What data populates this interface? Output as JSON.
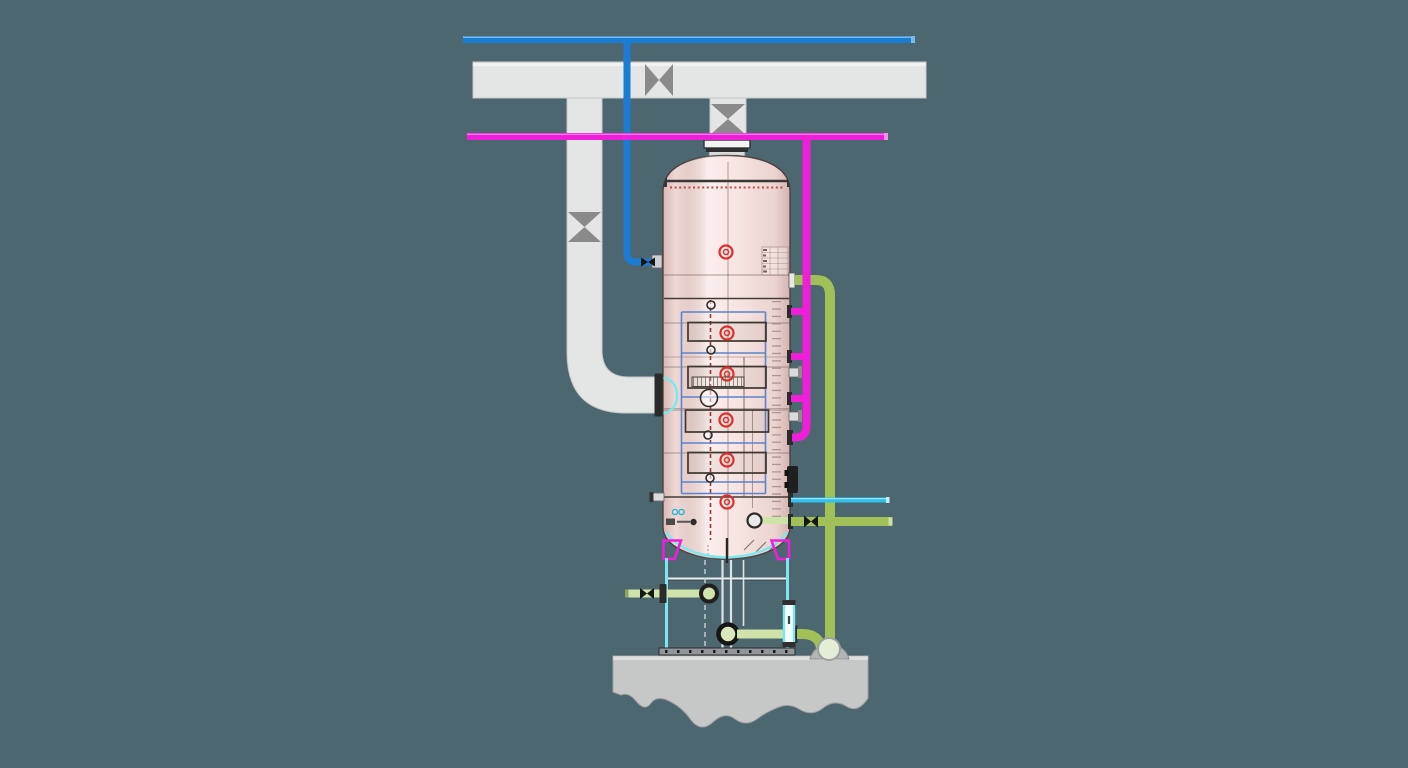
{
  "scene": {
    "type": "plant-equipment-illustration",
    "subject": "vertical scrubber column with exhaust ductwork, feed and recirculation piping on a concrete foundation",
    "canvas": {
      "width": 1408,
      "height": 768
    },
    "visible_text": ""
  },
  "colors": {
    "background": "#4d6770",
    "duct": "#e4e5e5",
    "duct_shadow": "#c6c8c8",
    "damper": "#8a8a8a",
    "blue_pipe": "#1b7cd4",
    "magenta_pipe": "#ef1fd9",
    "green_pipe": "#a0c158",
    "pale_green_pipe": "#cde3a9",
    "cyan_pipe": "#2fc0ee",
    "skirt_cyan": "#7be8f0",
    "vessel_pink": "#f6e1de",
    "internals_dark": "#453c36",
    "internals_blue": "#5c84ca",
    "handwheel_red": "#dd2f2a",
    "flange_dark": "#2b2b2b",
    "concrete": "#c6c8c8",
    "base_plate": "#90979a"
  },
  "components": {
    "duct_system": {
      "name": "exhaust-duct",
      "damper_count": 3
    },
    "vessel": {
      "name": "scrubber-column",
      "tray_count": 4,
      "handwheel_count": 6,
      "side_nozzle_count": 7
    },
    "pipes": [
      {
        "name": "blue-water-supply-line",
        "color_key": "blue_pipe"
      },
      {
        "name": "magenta-chemical-feed-line",
        "color_key": "magenta_pipe"
      },
      {
        "name": "green-recirculation-line",
        "color_key": "green_pipe"
      },
      {
        "name": "cyan-overflow-line",
        "color_key": "cyan_pipe"
      },
      {
        "name": "bottom-drain-line",
        "color_key": "pale_green_pipe"
      }
    ],
    "foundation": {
      "name": "concrete-foundation"
    }
  }
}
